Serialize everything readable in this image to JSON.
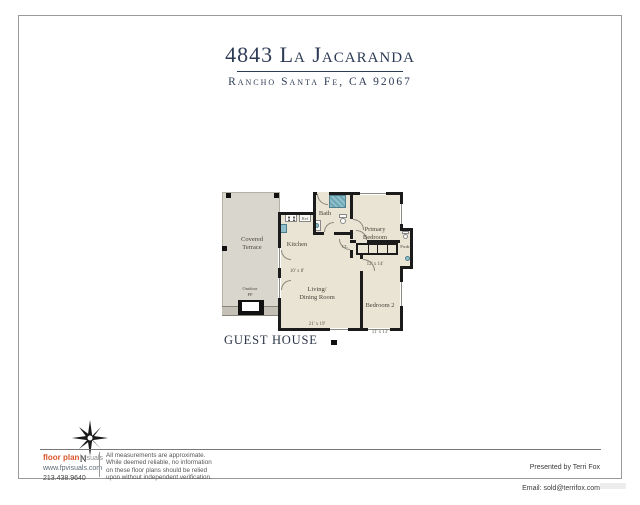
{
  "header": {
    "title": "4843 La Jacaranda",
    "subtitle": "Rancho Santa Fe, CA 92067",
    "accent_color": "#2e3b55"
  },
  "plan": {
    "caption": "GUEST HOUSE",
    "colors": {
      "floor": "#e9e4d4",
      "terrace": "#d9d6cd",
      "wall": "#1b1b1b",
      "fixture_teal": "#8fc0cb"
    },
    "rooms": {
      "terrace": {
        "name": "Covered\nTerrace"
      },
      "outdoor_fp": {
        "name": "Outdoor\nFP"
      },
      "kitchen": {
        "name": "Kitchen",
        "dims": "10' x 8'"
      },
      "bath": {
        "name": "Bath"
      },
      "primary": {
        "name": "Primary\nBedroom",
        "dims": "12' x 14'"
      },
      "living": {
        "name": "Living/\nDining Room",
        "dims": "21' x 19'"
      },
      "bedroom2": {
        "name": "Bedroom 2",
        "dims": "11' x 13'"
      },
      "pwdr": {
        "name": "Pwdr"
      },
      "closet": {
        "name": "CL"
      },
      "ref": {
        "name": "Ref"
      }
    }
  },
  "footer": {
    "compass_label": "N",
    "brand": {
      "primary": "floor plan",
      "secondary": "visuals",
      "website": "www.fpvisuals.com",
      "phone": "213.438.9640",
      "accent_color": "#d9542b"
    },
    "disclaimer": "All measurements are approximate.\nWhile deemed reliable, no information\non these floor plans should be relied\nupon without independent verification.",
    "presented_by": "Presented by Terri Fox",
    "email": "Email: sold@terrifox.com"
  }
}
